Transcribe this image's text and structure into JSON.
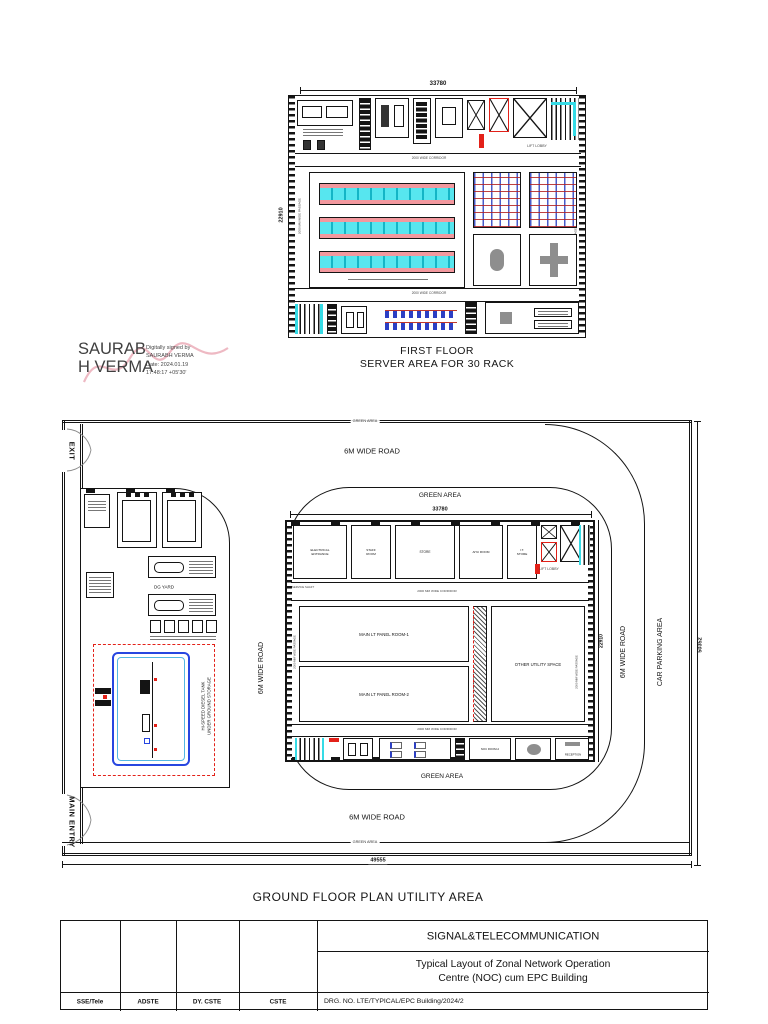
{
  "colors": {
    "line": "#141414",
    "accent_red": "#e32119",
    "rack_cyan": "#57e6ef",
    "rack_pink": "#f2989e",
    "tank_blue": "#2746e0",
    "tank_inner_cyan": "#53b7e3",
    "signature_squiggle": "#eeb9c3"
  },
  "first_floor": {
    "dim_top": "33780",
    "dim_left": "22910",
    "passage_left": "2000 MM WIDE PASSAGE",
    "passage_right": "2000 MM WIDE PASSAGE",
    "corridor_upper": "2000 WIDE CORRIDOR",
    "corridor_lower": "2000 WIDE CORRIDOR",
    "lift_lobby": "LIFT LOBBY",
    "title_line1": "FIRST FLOOR",
    "title_line2": "SERVER AREA FOR 30 RACK"
  },
  "signature": {
    "name_line1": "SAURAB",
    "name_line2": "H VERMA",
    "detail_line1": "Digitally signed by",
    "detail_line2": "SAURABH VERMA",
    "detail_line3": "Date: 2024.01.19",
    "detail_line4": "17:48:17 +05'30'"
  },
  "ground_floor": {
    "exit": "EXIT",
    "main_entry": "MAIN ENTRY",
    "green_area_strip_top": "GREEN AREA",
    "green_area_strip_bottom": "GREEN AREA",
    "road_top": "6M WIDE ROAD",
    "road_bottom": "6M WIDE ROAD",
    "road_left": "6M WIDE ROAD",
    "road_right": "6M WIDE ROAD",
    "green_area_top": "GREEN AREA",
    "green_area_bottom": "GREEN AREA",
    "car_parking": "CAR PARKING AREA",
    "dim_building_top": "33780",
    "dim_building_right": "22910",
    "dim_plot_right": "50352",
    "dim_plot_bottom": "49555",
    "dg_yard": "DG YARD",
    "diesel_tank": "HI-SPEED DIESEL TANK\nUNDER GROUND STORAGE",
    "building": {
      "room_electrical": "ELECTRICAL\nENTRANCE",
      "room_staff": "STAFF\nROOM",
      "room_store": "STORE",
      "room_ahu": "AHU ROOM",
      "room_it": "I.T.\nSTORE",
      "lift_lobby": "LIFT LOBBY",
      "service_shaft": "SERVICE SHAFT",
      "corridor_top": "2000 MM WIDE CORRIDOR",
      "corridor_bottom": "2000 MM WIDE CORRIDOR",
      "passage_left": "2000 MM WIDE PASSAGE",
      "passage_right": "2000 MM WIDE PASSAGE",
      "lt_room1": "MAIN LT PANEL ROOM-1",
      "lt_room2": "MAIN LT PANEL ROOM-2",
      "utility": "OTHER UTILITY SPACE",
      "noc_room": "NOC ROOM-2",
      "reception": "RECEPTION"
    },
    "title": "GROUND FLOOR PLAN UTILITY AREA"
  },
  "title_block": {
    "department": "SIGNAL&TELECOMMUNICATION",
    "drawing_title_line1": "Typical Layout of Zonal Network Operation",
    "drawing_title_line2": "Centre (NOC) cum EPC Building",
    "drg_no": "DRG. NO. LTE/TYPICAL/EPC Building/2024/2",
    "sign_labels": [
      "SSE/Tele",
      "ADSTE",
      "DY. CSTE",
      "CSTE"
    ]
  }
}
